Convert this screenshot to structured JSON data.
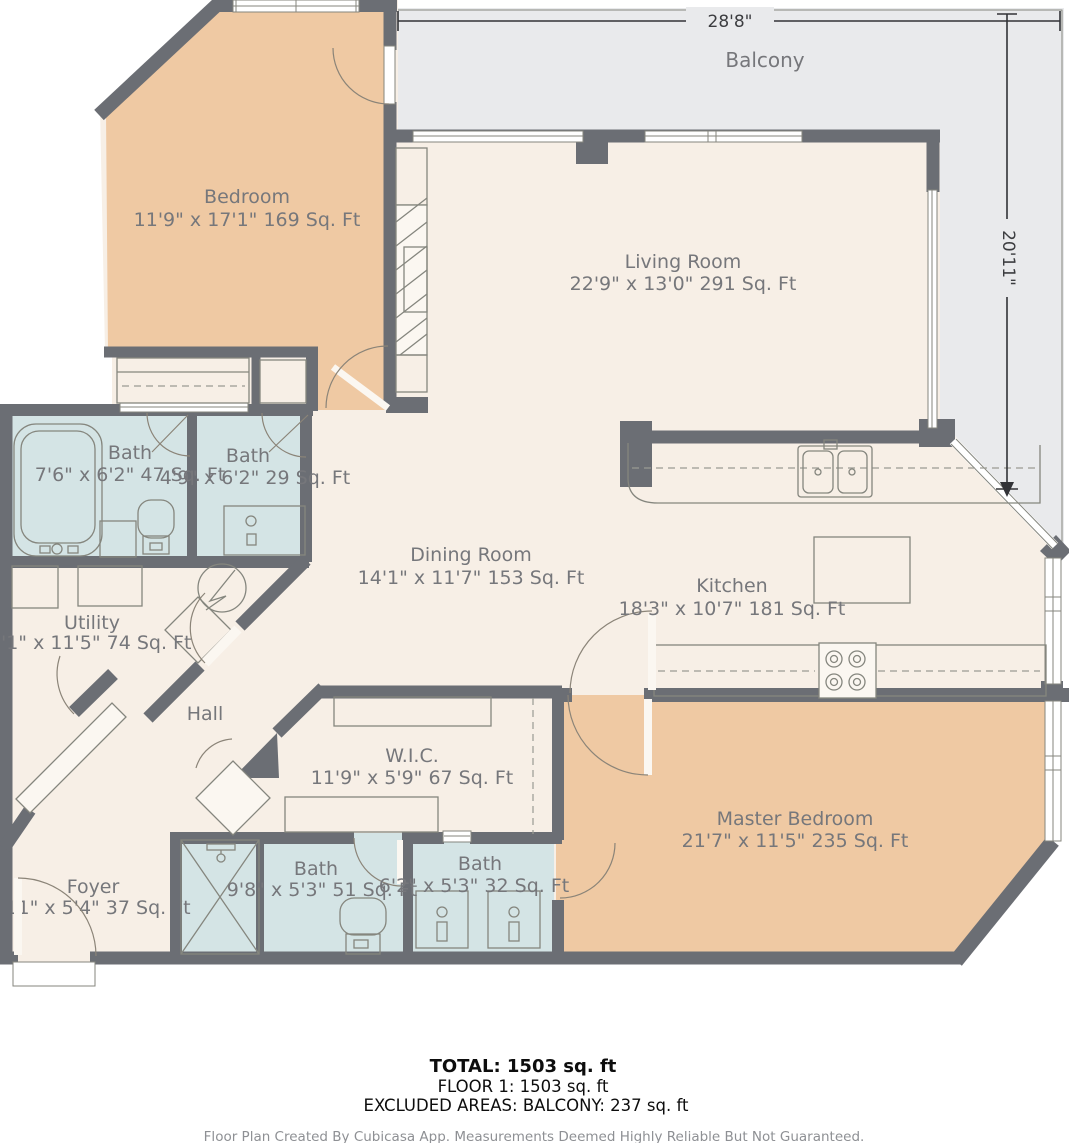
{
  "rooms": {
    "balcony": {
      "name": "Balcony",
      "dims": ""
    },
    "bedroom": {
      "name": "Bedroom",
      "dims": "11'9\" x 17'1\" 169 Sq. Ft"
    },
    "living": {
      "name": "Living Room",
      "dims": "22'9\" x 13'0\" 291 Sq. Ft"
    },
    "bath1": {
      "name": "Bath",
      "dims": "7'6\" x 6'2\" 47 Sq. Ft"
    },
    "bath2": {
      "name": "Bath",
      "dims": "4'9\" x 6'2\" 29 Sq. Ft"
    },
    "dining": {
      "name": "Dining Room",
      "dims": "14'1\" x 11'7\" 153 Sq. Ft"
    },
    "kitchen": {
      "name": "Kitchen",
      "dims": "18'3\" x 10'7\" 181 Sq. Ft"
    },
    "utility": {
      "name": "Utility",
      "dims": "'1\" x 11'5\" 74 Sq. Ft"
    },
    "hall": {
      "name": "Hall",
      "dims": ""
    },
    "wic": {
      "name": "W.I.C.",
      "dims": "11'9\" x 5'9\" 67 Sq. Ft"
    },
    "master": {
      "name": "Master Bedroom",
      "dims": "21'7\" x 11'5\" 235 Sq. Ft"
    },
    "foyer": {
      "name": "Foyer",
      "dims": "11\" x 5'4\" 37 Sq. Ft"
    },
    "bath3": {
      "name": "Bath",
      "dims": "9'8\" x 5'3\" 51 Sq. Ft"
    },
    "bath4": {
      "name": "Bath",
      "dims": "6'2\" x 5'3\" 32 Sq. Ft"
    }
  },
  "dimensions": {
    "width_label": "28'8\"",
    "height_label": "20'11\""
  },
  "summary": {
    "total": "TOTAL: 1503 sq. ft",
    "floor": "FLOOR 1: 1503 sq. ft",
    "excluded": "EXCLUDED AREAS: BALCONY: 237 sq. ft"
  },
  "footer": {
    "text": "Floor Plan Created By Cubicasa App. Measurements Deemed Highly Reliable But Not Guaranteed."
  },
  "colors": {
    "wall": "#6b6e74",
    "room_floor": "#f7efe6",
    "bedroom_floor": "#efc9a3",
    "bathroom_floor": "#d4e4e5",
    "balcony_floor": "#e9eaec",
    "label_text": "#76777b"
  }
}
